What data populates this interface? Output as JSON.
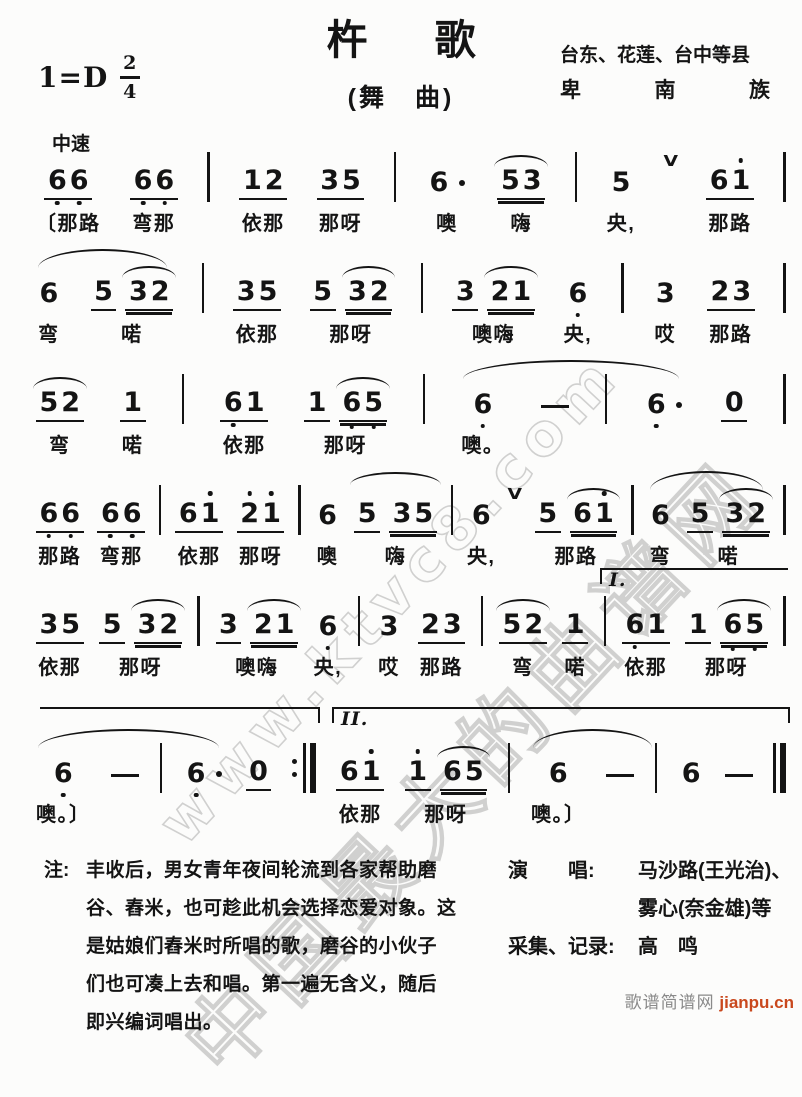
{
  "header": {
    "key": "1=D",
    "time_top": "2",
    "time_bottom": "4",
    "title": "杵　歌",
    "subtitle": "(舞　曲)",
    "region": "台东、花莲、台中等县",
    "ethnic": "卑南族",
    "tempo": "中速"
  },
  "systems": [
    {
      "cells": [
        {
          "toks": [
            {
              "d": "66",
              "u": 1,
              "db": [
                0,
                1
              ]
            }
          ],
          "lyr": "〔那路"
        },
        {
          "toks": [
            {
              "d": "66",
              "u": 1,
              "db": [
                0,
                1
              ]
            }
          ],
          "lyr": "弯那"
        },
        {
          "bar": "|"
        },
        {
          "toks": [
            {
              "d": "12",
              "u": 1
            }
          ],
          "lyr": "依那"
        },
        {
          "toks": [
            {
              "d": "35",
              "u": 1
            }
          ],
          "lyr": "那呀"
        },
        {
          "bar": "|"
        },
        {
          "toks": [
            {
              "d": "6",
              "aft": 1
            }
          ],
          "lyr": "噢"
        },
        {
          "toks": [
            {
              "d": "53",
              "u": 2,
              "arc": 1
            }
          ],
          "lyr": "嗨"
        },
        {
          "bar": "|"
        },
        {
          "toks": [
            {
              "d": "5"
            }
          ],
          "lyr": "央,"
        },
        {
          "breath": 1
        },
        {
          "toks": [
            {
              "d": "61",
              "u": 1,
              "da": [
                1
              ]
            }
          ],
          "lyr": "那路"
        },
        {
          "bar": "|"
        }
      ]
    },
    {
      "cells": [
        {
          "toks": [
            {
              "d": "6"
            }
          ],
          "lyr": "弯",
          "slur": 1
        },
        {
          "toks": [
            {
              "d": "5",
              "u": 1
            },
            {
              "d": "32",
              "u": 2,
              "arc": 1
            }
          ],
          "lyr": "喏"
        },
        {
          "bar": "|"
        },
        {
          "toks": [
            {
              "d": "35",
              "u": 1
            }
          ],
          "lyr": "依那"
        },
        {
          "toks": [
            {
              "d": "5",
              "u": 1
            },
            {
              "d": "32",
              "u": 2,
              "arc": 1
            }
          ],
          "lyr": "那呀"
        },
        {
          "bar": "|"
        },
        {
          "toks": [
            {
              "d": "3",
              "u": 1
            },
            {
              "d": "21",
              "u": 2,
              "arc": 1
            }
          ],
          "lyr": "噢嗨"
        },
        {
          "toks": [
            {
              "d": "6",
              "db": [
                0
              ]
            }
          ],
          "lyr": "央,"
        },
        {
          "bar": "|"
        },
        {
          "toks": [
            {
              "d": "3"
            }
          ],
          "lyr": "哎"
        },
        {
          "toks": [
            {
              "d": "23",
              "u": 1
            }
          ],
          "lyr": "那路"
        },
        {
          "bar": "|"
        }
      ]
    },
    {
      "cells": [
        {
          "toks": [
            {
              "d": "52",
              "u": 1,
              "arc": 1
            }
          ],
          "lyr": "弯"
        },
        {
          "toks": [
            {
              "d": "1",
              "u": 1
            }
          ],
          "lyr": "喏"
        },
        {
          "bar": "|"
        },
        {
          "toks": [
            {
              "d": "61",
              "u": 1,
              "db": [
                0
              ]
            }
          ],
          "lyr": "依那"
        },
        {
          "toks": [
            {
              "d": "1",
              "u": 1
            },
            {
              "d": "65",
              "u": 2,
              "db": [
                0,
                1
              ],
              "arc": 1
            }
          ],
          "lyr": "那呀"
        },
        {
          "bar": "|"
        },
        {
          "toks": [
            {
              "d": "6",
              "db": [
                0
              ]
            }
          ],
          "lyr": "噢。",
          "slur": 3
        },
        {
          "dash": 1
        },
        {
          "bar": "|"
        },
        {
          "toks": [
            {
              "d": "6",
              "db": [
                0
              ],
              "aft": 1
            }
          ]
        },
        {
          "toks": [
            {
              "d": "0",
              "u": 1
            }
          ]
        },
        {
          "bar": "|"
        }
      ]
    },
    {
      "cells": [
        {
          "toks": [
            {
              "d": "66",
              "u": 1,
              "db": [
                0,
                1
              ]
            }
          ],
          "lyr": "那路"
        },
        {
          "toks": [
            {
              "d": "66",
              "u": 1,
              "db": [
                0,
                1
              ]
            }
          ],
          "lyr": "弯那"
        },
        {
          "bar": "|"
        },
        {
          "toks": [
            {
              "d": "61",
              "u": 1,
              "da": [
                1
              ]
            }
          ],
          "lyr": "依那"
        },
        {
          "toks": [
            {
              "d": "21",
              "u": 1,
              "da": [
                0,
                1
              ]
            }
          ],
          "lyr": "那呀"
        },
        {
          "bar": "|"
        },
        {
          "toks": [
            {
              "d": "6"
            }
          ],
          "lyr": "噢"
        },
        {
          "toks": [
            {
              "d": "5",
              "u": 1
            },
            {
              "d": "35",
              "u": 2
            }
          ],
          "lyr": "嗨",
          "arc": 1
        },
        {
          "bar": "|"
        },
        {
          "toks": [
            {
              "d": "6"
            }
          ],
          "lyr": "央,"
        },
        {
          "breath": 1
        },
        {
          "toks": [
            {
              "d": "5",
              "u": 1
            },
            {
              "d": "61",
              "u": 2,
              "da": [
                1
              ],
              "arc": 1
            }
          ],
          "lyr": "那路"
        },
        {
          "bar": "|"
        },
        {
          "toks": [
            {
              "d": "6"
            }
          ],
          "lyr": "弯",
          "slur": 1
        },
        {
          "toks": [
            {
              "d": "5",
              "u": 1
            },
            {
              "d": "32",
              "u": 2,
              "arc": 1
            }
          ],
          "lyr": "喏"
        },
        {
          "bar": "|"
        }
      ]
    },
    {
      "cells": [
        {
          "toks": [
            {
              "d": "35",
              "u": 1
            }
          ],
          "lyr": "依那"
        },
        {
          "toks": [
            {
              "d": "5",
              "u": 1
            },
            {
              "d": "32",
              "u": 2,
              "arc": 1
            }
          ],
          "lyr": "那呀"
        },
        {
          "bar": "|"
        },
        {
          "toks": [
            {
              "d": "3",
              "u": 1
            },
            {
              "d": "21",
              "u": 2,
              "arc": 1
            }
          ],
          "lyr": "噢嗨"
        },
        {
          "toks": [
            {
              "d": "6",
              "db": [
                0
              ]
            }
          ],
          "lyr": "央,"
        },
        {
          "bar": "|"
        },
        {
          "toks": [
            {
              "d": "3"
            }
          ],
          "lyr": "哎"
        },
        {
          "toks": [
            {
              "d": "23",
              "u": 1
            }
          ],
          "lyr": "那路"
        },
        {
          "bar": "|"
        },
        {
          "toks": [
            {
              "d": "52",
              "u": 1,
              "arc": 1
            }
          ],
          "lyr": "弯"
        },
        {
          "toks": [
            {
              "d": "1",
              "u": 1
            }
          ],
          "lyr": "喏"
        },
        {
          "bar": "|"
        },
        {
          "toks": [
            {
              "d": "61",
              "u": 1,
              "db": [
                0
              ]
            }
          ],
          "lyr": "依那"
        },
        {
          "toks": [
            {
              "d": "1",
              "u": 1
            },
            {
              "d": "65",
              "u": 2,
              "db": [
                0,
                1
              ],
              "arc": 1
            }
          ],
          "lyr": "那呀"
        },
        {
          "bar": "|"
        }
      ],
      "voltas": [
        {
          "label": "I.",
          "start": 11,
          "end": "end",
          "ticks": "l"
        }
      ]
    },
    {
      "cells": [
        {
          "toks": [
            {
              "d": "6",
              "db": [
                0
              ]
            }
          ],
          "lyr": "噢。〕",
          "slur": 3
        },
        {
          "dash": 1
        },
        {
          "bar": "|"
        },
        {
          "toks": [
            {
              "d": "6",
              "db": [
                0
              ],
              "aft": 1
            }
          ]
        },
        {
          "toks": [
            {
              "d": "0",
              "u": 1
            }
          ]
        },
        {
          "bar": ":|"
        },
        {
          "toks": [
            {
              "d": "61",
              "u": 1,
              "da": [
                1
              ]
            }
          ],
          "lyr": "依那"
        },
        {
          "toks": [
            {
              "d": "1",
              "u": 1,
              "da": [
                0
              ]
            },
            {
              "d": "65",
              "u": 2,
              "arc": 1
            }
          ],
          "lyr": "那呀"
        },
        {
          "bar": "|"
        },
        {
          "toks": [
            {
              "d": "6"
            }
          ],
          "lyr": "噢。〕",
          "slur": 2
        },
        {
          "dash": 1
        },
        {
          "bar": "|"
        },
        {
          "toks": [
            {
              "d": "6"
            }
          ]
        },
        {
          "dash": 1
        },
        {
          "bar": "||"
        }
      ],
      "voltas": [
        {
          "label": "",
          "start": "begin",
          "end": 5,
          "ticks": "r"
        },
        {
          "label": "II.",
          "start": 6,
          "end": "end",
          "ticks": "lr"
        }
      ]
    }
  ],
  "footnote": {
    "label": "注:",
    "lines": [
      "丰收后，男女青年夜间轮流到各家帮助磨",
      "谷、舂米，也可趁此机会选择恋爱对象。这",
      "是姑娘们舂米时所唱的歌，磨谷的小伙子",
      "们也可凑上去和唱。第一遍无含义，随后",
      "即兴编词唱出。"
    ]
  },
  "credits": {
    "rows": [
      {
        "label": "演　　唱:",
        "value": "马沙路(王光治)、"
      },
      {
        "label": "",
        "value": "雾心(奈金雄)等"
      },
      {
        "label": "采集、记录:",
        "value": "高　鸣"
      }
    ]
  },
  "watermark": {
    "line1": "www.ktvc8.com",
    "line2": "中国最大的曲谱网",
    "color": "#c8c8c8"
  },
  "footer": {
    "site": "歌谱简谱网",
    "url": "jianpu.cn",
    "url_color": "#c9481d",
    "site_color": "#8a8a8a"
  }
}
